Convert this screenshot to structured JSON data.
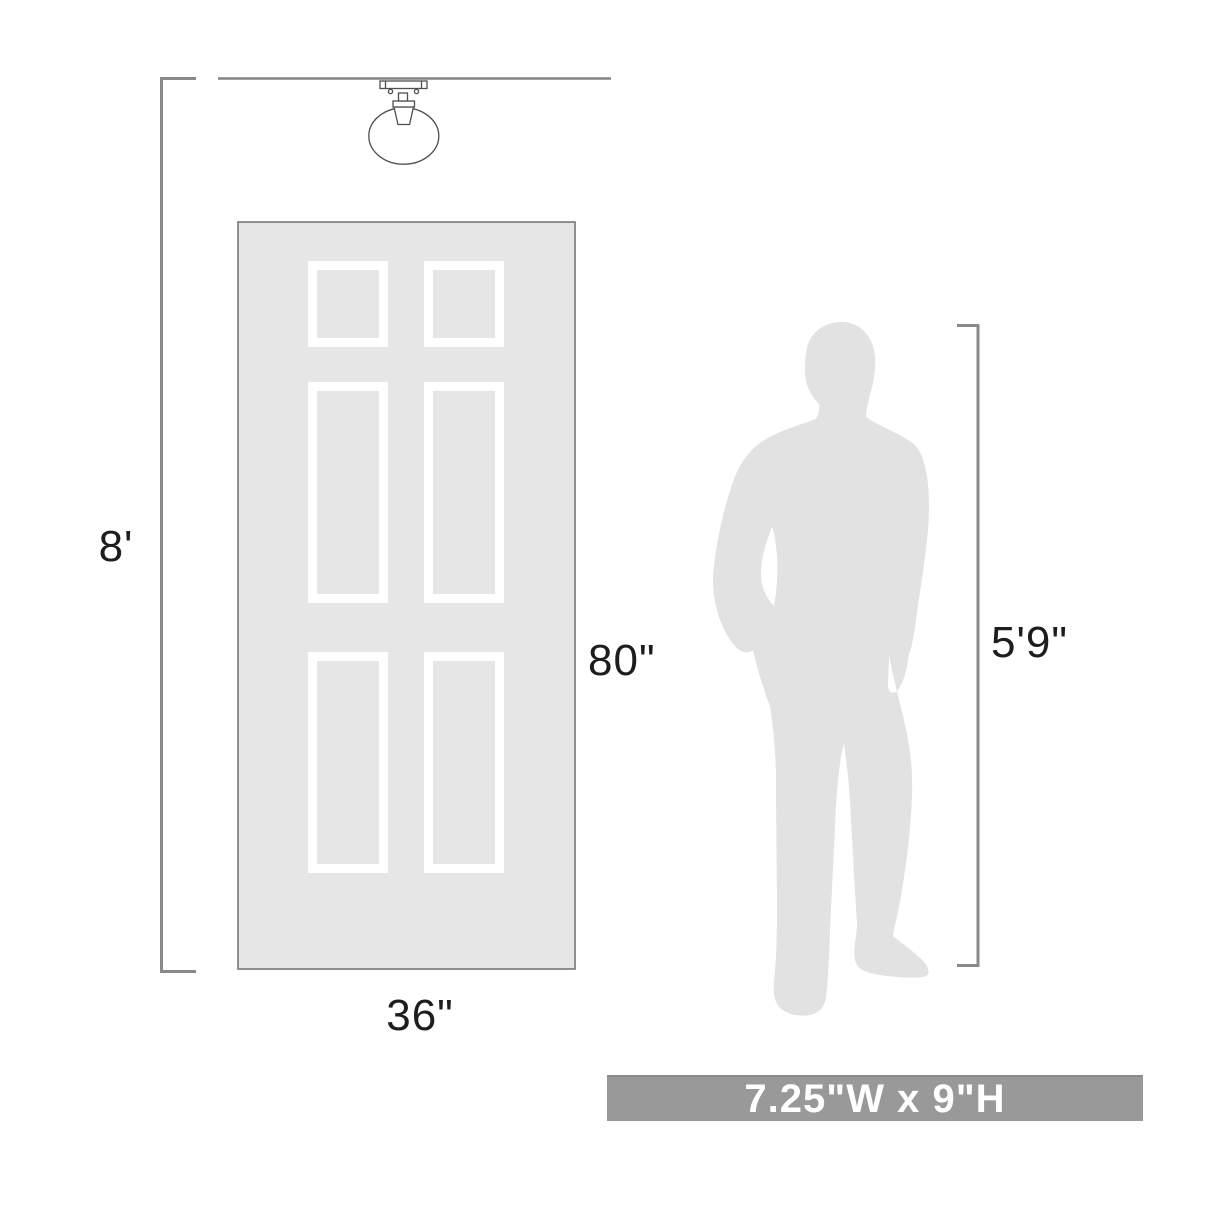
{
  "diagram": {
    "type": "product-scale-dimension-diagram",
    "labels": {
      "ceiling_height": "8'",
      "door_height": "80\"",
      "door_width": "36\"",
      "person_height": "5'9\""
    },
    "banner": {
      "product_size": "7.25\"W x 9\"H"
    },
    "figures": [
      "flush-mount-globe-light-fixture",
      "six-panel-door",
      "person-silhouette"
    ],
    "colors": {
      "background": "#ffffff",
      "door_fill": "#e6e6e7",
      "door_border": "#777777",
      "panel_frame": "#ffffff",
      "silhouette_fill": "#e2e2e2",
      "dimension_line": "#8a8a8a",
      "ceiling_line": "#838383",
      "fixture_stroke": "#4f4f4f",
      "label_text": "#1d1d1d",
      "banner_bg": "#999999",
      "banner_text": "#ffffff"
    }
  }
}
